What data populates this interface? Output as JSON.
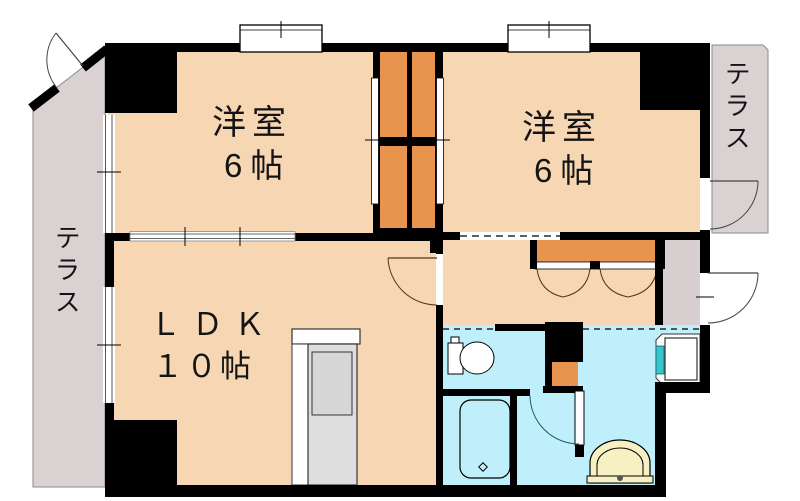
{
  "plan": {
    "type": "apartment-floor-plan",
    "rooms": {
      "bedroom_left": {
        "name": "洋室",
        "size": "6帖"
      },
      "bedroom_right": {
        "name": "洋室",
        "size": "6帖"
      },
      "ldk": {
        "name": "ＬＤＫ",
        "size": "１０帖"
      },
      "terrace_left": {
        "name": "テラス"
      },
      "terrace_right": {
        "name": "テラス"
      }
    },
    "fixtures": [
      "toilet",
      "bathtub",
      "wash-basin",
      "washing-machine-pan",
      "kitchen-counter",
      "closet-left",
      "closet-right",
      "hall-closet",
      "storage-box"
    ],
    "colors": {
      "floor": "#f7d7b3",
      "closet": "#e8944e",
      "terrace": "#dad2d2",
      "wet_area": "#bfeffa",
      "wall": "#000000",
      "basin": "#f6f0c2",
      "faucet_teal": "#38c3cd",
      "kitchen": "#dedede"
    }
  }
}
